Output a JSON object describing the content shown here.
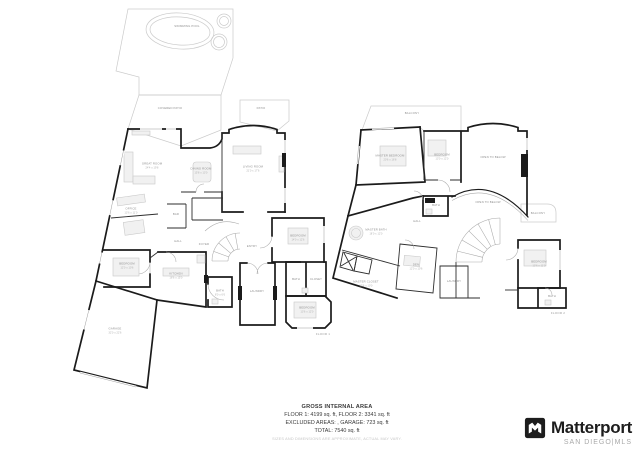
{
  "page": {
    "background": "#ffffff"
  },
  "colors": {
    "wall": "#1b1b1b",
    "interior_wall": "#2e2e2e",
    "outdoor_line": "#cbcbcb",
    "detail_line": "#a9a9a9",
    "label_text": "#8f8f8f",
    "summary_text": "#3a3a3a",
    "disclaimer_text": "#c6c6c6",
    "logo_black": "#1d1d1d",
    "logo_sub_gray": "#a9a9a9"
  },
  "summary": {
    "title": "GROSS INTERNAL AREA",
    "line1": "FLOOR 1: 4199 sq. ft, FLOOR 2: 3341 sq. ft",
    "line2": "EXCLUDED AREAS: , GARAGE: 723 sq. ft",
    "line3": "TOTAL: 7540 sq. ft",
    "disclaimer": "SIZES AND DIMENSIONS ARE APPROXIMATE, ACTUAL MAY VARY."
  },
  "branding": {
    "logo_text": "Matterport",
    "sub_text": "SAN DIEGO|MLS",
    "logo_icon": "matterport-m-icon"
  },
  "floor1": {
    "tag": "FLOOR 1",
    "labels": [
      {
        "name": "pool-label",
        "text": "SWIMMING POOL",
        "x": 187,
        "y": 27
      },
      {
        "name": "covered-patio-label",
        "text": "COVERED PATIO",
        "x": 170,
        "y": 109
      },
      {
        "name": "patio-label",
        "text": "PATIO",
        "x": 261,
        "y": 109
      },
      {
        "name": "great-room-label",
        "text": "GREAT ROOM",
        "dims": "24'4 x 19'8",
        "x": 152,
        "y": 166
      },
      {
        "name": "dining-room-label",
        "text": "DINING ROOM",
        "dims": "15'8 x 13'0",
        "x": 201,
        "y": 171
      },
      {
        "name": "living-room-label",
        "text": "LIVING ROOM",
        "dims": "21'0 x 17'6",
        "x": 253,
        "y": 169
      },
      {
        "name": "office-label",
        "text": "OFFICE",
        "dims": "13'6 x 11'0",
        "x": 131,
        "y": 211
      },
      {
        "name": "bar-label",
        "text": "BAR",
        "x": 176,
        "y": 215
      },
      {
        "name": "hall-label",
        "text": "HALL",
        "x": 178,
        "y": 242
      },
      {
        "name": "foyer-label",
        "text": "FOYER",
        "x": 204,
        "y": 245
      },
      {
        "name": "entry-label",
        "text": "ENTRY",
        "x": 252,
        "y": 247
      },
      {
        "name": "bedroom-ne-label",
        "text": "BEDROOM",
        "dims": "14'0 x 12'6",
        "x": 298,
        "y": 238
      },
      {
        "name": "bath-ne-label",
        "text": "BATH",
        "x": 296,
        "y": 280
      },
      {
        "name": "closet-ne-label",
        "text": "CLOSET",
        "x": 316,
        "y": 280
      },
      {
        "name": "bedroom-w-label",
        "text": "BEDROOM",
        "dims": "12'0 x 10'6",
        "x": 127,
        "y": 266
      },
      {
        "name": "kitchen-label",
        "text": "KITCHEN",
        "dims": "18'6 x 15'0",
        "x": 176,
        "y": 276
      },
      {
        "name": "bath-c-label",
        "text": "BATH",
        "dims": "8'0 x 6'6",
        "x": 220,
        "y": 293
      },
      {
        "name": "laundry-label",
        "text": "LAUNDRY",
        "x": 257,
        "y": 292
      },
      {
        "name": "bedroom-se-label",
        "text": "BEDROOM",
        "dims": "13'6 x 12'0",
        "x": 307,
        "y": 310
      },
      {
        "name": "garage-label",
        "text": "GARAGE",
        "dims": "32'0 x 22'6",
        "x": 115,
        "y": 331
      }
    ]
  },
  "floor2": {
    "tag": "FLOOR 2",
    "labels": [
      {
        "name": "balcony-rear-label",
        "text": "BALCONY",
        "x": 412,
        "y": 114
      },
      {
        "name": "master-bedroom-label",
        "text": "MASTER BEDROOM",
        "dims": "20'6 x 16'8",
        "x": 390,
        "y": 158
      },
      {
        "name": "bedroom-n-label",
        "text": "BEDROOM",
        "dims": "13'0 x 12'0",
        "x": 442,
        "y": 157
      },
      {
        "name": "open-below-label",
        "text": "OPEN TO BELOW",
        "x": 493,
        "y": 158
      },
      {
        "name": "open-below-stair-label",
        "text": "OPEN TO BELOW",
        "x": 488,
        "y": 203
      },
      {
        "name": "bath-n-label",
        "text": "BATH",
        "x": 436,
        "y": 206
      },
      {
        "name": "hall2-label",
        "text": "HALL",
        "x": 417,
        "y": 222
      },
      {
        "name": "master-bath-label",
        "text": "MASTER BATH",
        "dims": "16'0 x 12'0",
        "x": 376,
        "y": 232
      },
      {
        "name": "master-closet-label",
        "text": "MASTER CLOSET",
        "dims": "15'6 x 10'0",
        "x": 366,
        "y": 284
      },
      {
        "name": "den-label",
        "text": "DEN",
        "dims": "12'0 x 10'6",
        "x": 416,
        "y": 267
      },
      {
        "name": "laundry2-label",
        "text": "LAUNDRY",
        "x": 454,
        "y": 282
      },
      {
        "name": "balcony-side-label",
        "text": "BALCONY",
        "x": 538,
        "y": 214
      },
      {
        "name": "bedroom-e-label",
        "text": "BEDROOM",
        "dims": "13'6 x 11'0",
        "x": 539,
        "y": 264
      },
      {
        "name": "bath-e-label",
        "text": "BATH",
        "x": 552,
        "y": 297
      }
    ]
  }
}
